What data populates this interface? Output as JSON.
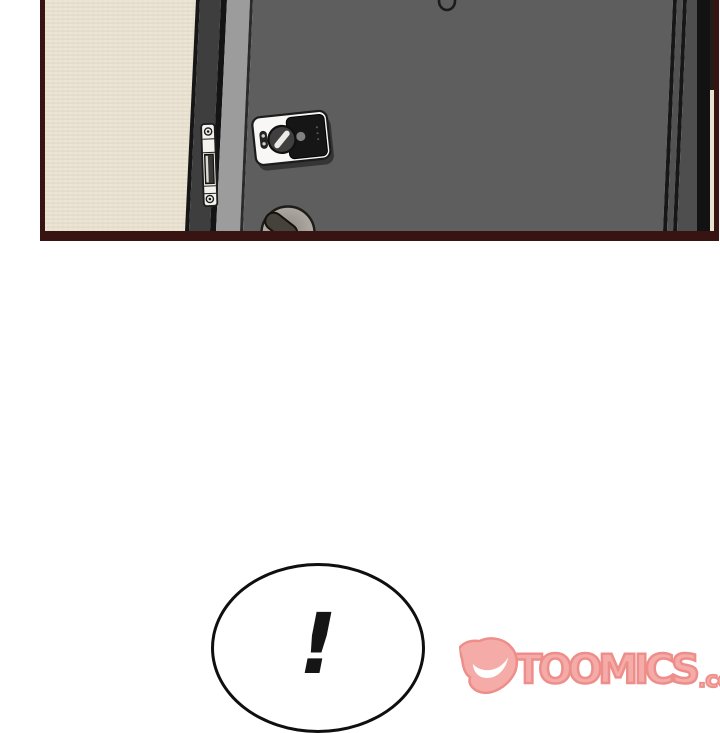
{
  "panel": {
    "colors": {
      "border": "#371311",
      "wall": "#ece5d6",
      "wall_weave": "#ded4c1",
      "frame_shadow": "#161616",
      "frame_dark_strip": "#3e3e3e",
      "frame_light_strip": "#9c9c9c",
      "door": "#5e5e5e",
      "door_edge_line": "#171717",
      "right_black_band": "#121212",
      "right_wall_sliver": "#e9e1d0",
      "strike_plate": "#f4f2ec",
      "lock_body": "#f8f7f5",
      "lock_panel": "#161616",
      "thumbturn": "#3f3f3f",
      "handle_rosette": "#b3afa8",
      "handle_lever": "#44423a"
    }
  },
  "bubble": {
    "text": "!"
  },
  "logo": {
    "text": "TOOMICS",
    "suffix": ".com",
    "fill": "#f5aba7",
    "outline": "#ee8e8a"
  }
}
